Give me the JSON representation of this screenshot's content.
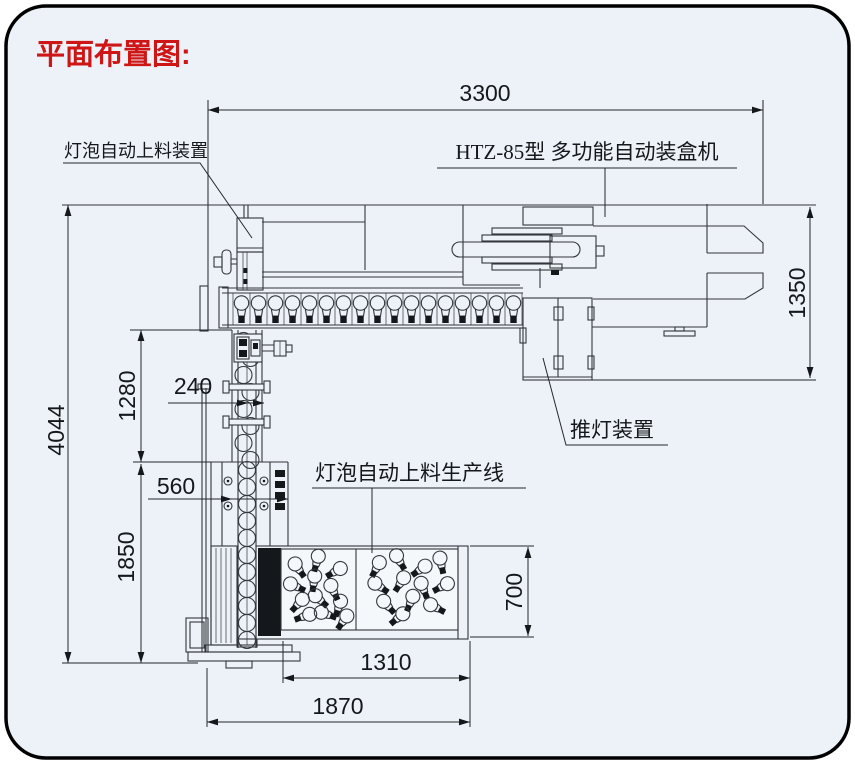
{
  "title": "平面布置图:",
  "labels": {
    "bulb_feeder": "灯泡自动上料装置",
    "boxing_machine": "HTZ-85型 多功能自动装盒机",
    "lamp_pusher": "推灯装置",
    "feeding_line": "灯泡自动上料生产线"
  },
  "dimensions": {
    "machine_length": "3300",
    "machine_depth": "1350",
    "total_depth": "4044",
    "conveyor_section_height": "1280",
    "conveyor_width": "240",
    "lower_section_width": "560",
    "lower_section_height": "1850",
    "bulb_box_depth": "700",
    "bulb_box_width": "1310",
    "base_width": "1870"
  },
  "colors": {
    "title_red": "#cf1616",
    "line_color": "#33373c",
    "background": "#ecf2f8"
  }
}
